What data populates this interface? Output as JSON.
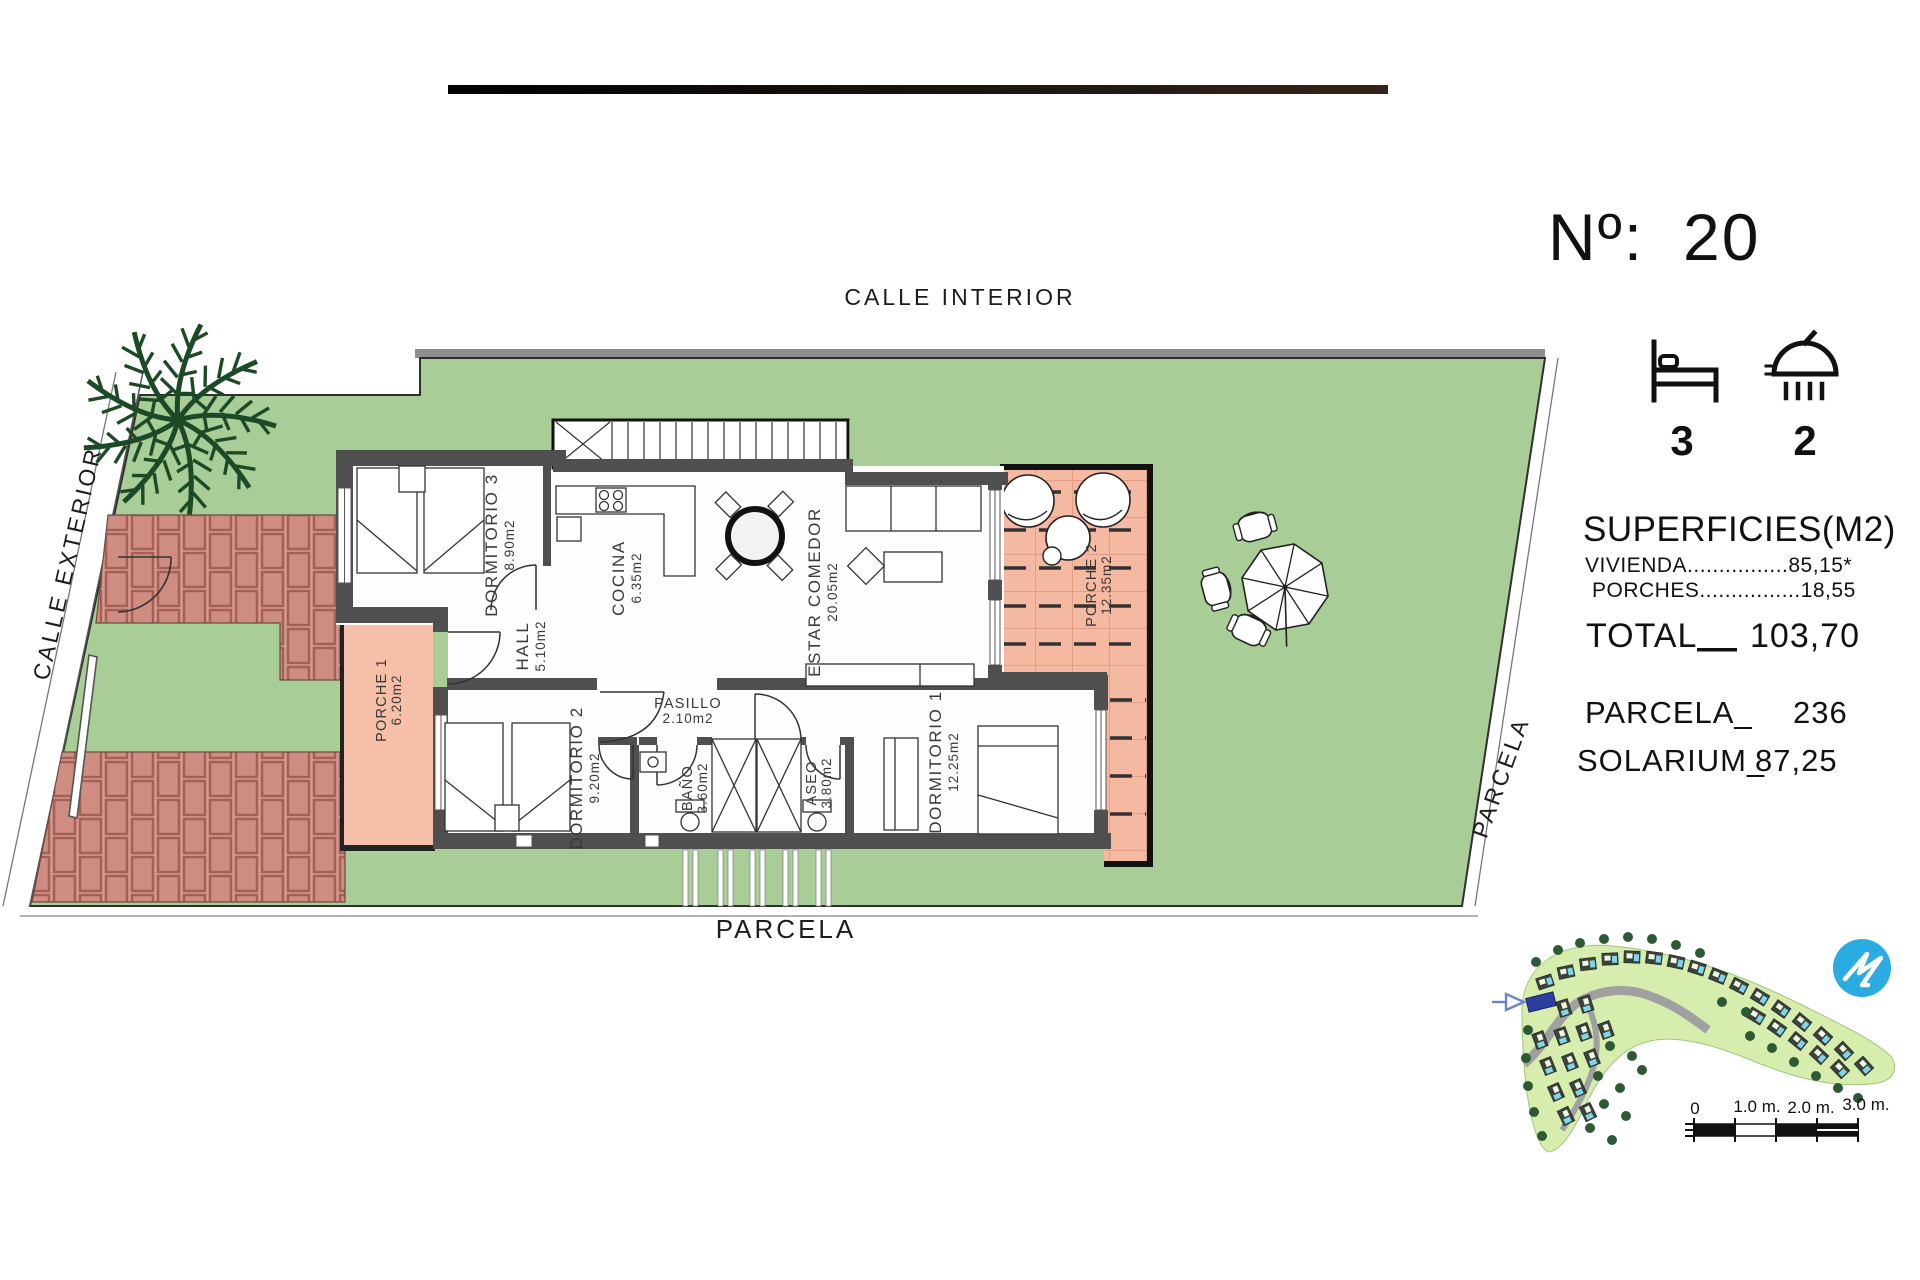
{
  "header": {
    "number_label": "Nº:",
    "number_value": "20",
    "bedrooms": "3",
    "bathrooms": "2"
  },
  "streets": {
    "top": "CALLE INTERIOR",
    "left": "CALLE EXTERIOR",
    "bottom": "PARCELA",
    "right": "PARCELA"
  },
  "rooms": {
    "dormitorio3": {
      "label": "DORMITORIO 3",
      "area": "8.90m2"
    },
    "cocina": {
      "label": "COCINA",
      "area": "6.35m2"
    },
    "estar_comedor": {
      "label": "ESTAR COMEDOR",
      "area": "20.05m2"
    },
    "hall": {
      "label": "HALL",
      "area": "5.10m2"
    },
    "pasillo": {
      "label": "PASILLO",
      "area": "2.10m2"
    },
    "dormitorio2": {
      "label": "DORMITORIO 2",
      "area": "9.20m2"
    },
    "banio": {
      "label": "BAÑO",
      "area": "3.60m2"
    },
    "aseo": {
      "label": "ASEO",
      "area": "3.80m2"
    },
    "dormitorio1": {
      "label": "DORMITORIO 1",
      "area": "12.25m2"
    },
    "porche1": {
      "label": "PORCHE 1",
      "area": "6.20m2"
    },
    "porche2": {
      "label": "PORCHE 2",
      "area": "12.35m2"
    }
  },
  "legend": {
    "title": "SUPERFICIES(M2)",
    "vivienda_line": "VIVIENDA................85,15*",
    "porches_line": "PORCHES................18,55",
    "total_label": "TOTAL",
    "total_value": "103,70",
    "parcela_label": "PARCELA_",
    "parcela_value": "236",
    "solarium_label": "SOLARIUM_",
    "solarium_value": "87,25"
  },
  "scalebar": {
    "t0": "0",
    "t1": "1.0 m.",
    "t2": "2.0 m.",
    "t3": "3.0 m."
  },
  "colors": {
    "grass": "#a9cd97",
    "porch": "#f5b9a1",
    "brick": "#cf8d82",
    "brick_joint": "#a55f54",
    "wall": "#4f4f4f",
    "palm": "#1d4a26",
    "map_green": "#d7edad",
    "map_tree": "#2d5a35",
    "map_road": "#a0a0a0",
    "pool": "#7fd6e8",
    "highlight_plot": "#2e3e9e",
    "logo_blue": "#2aabe2",
    "ink": "#111111"
  }
}
